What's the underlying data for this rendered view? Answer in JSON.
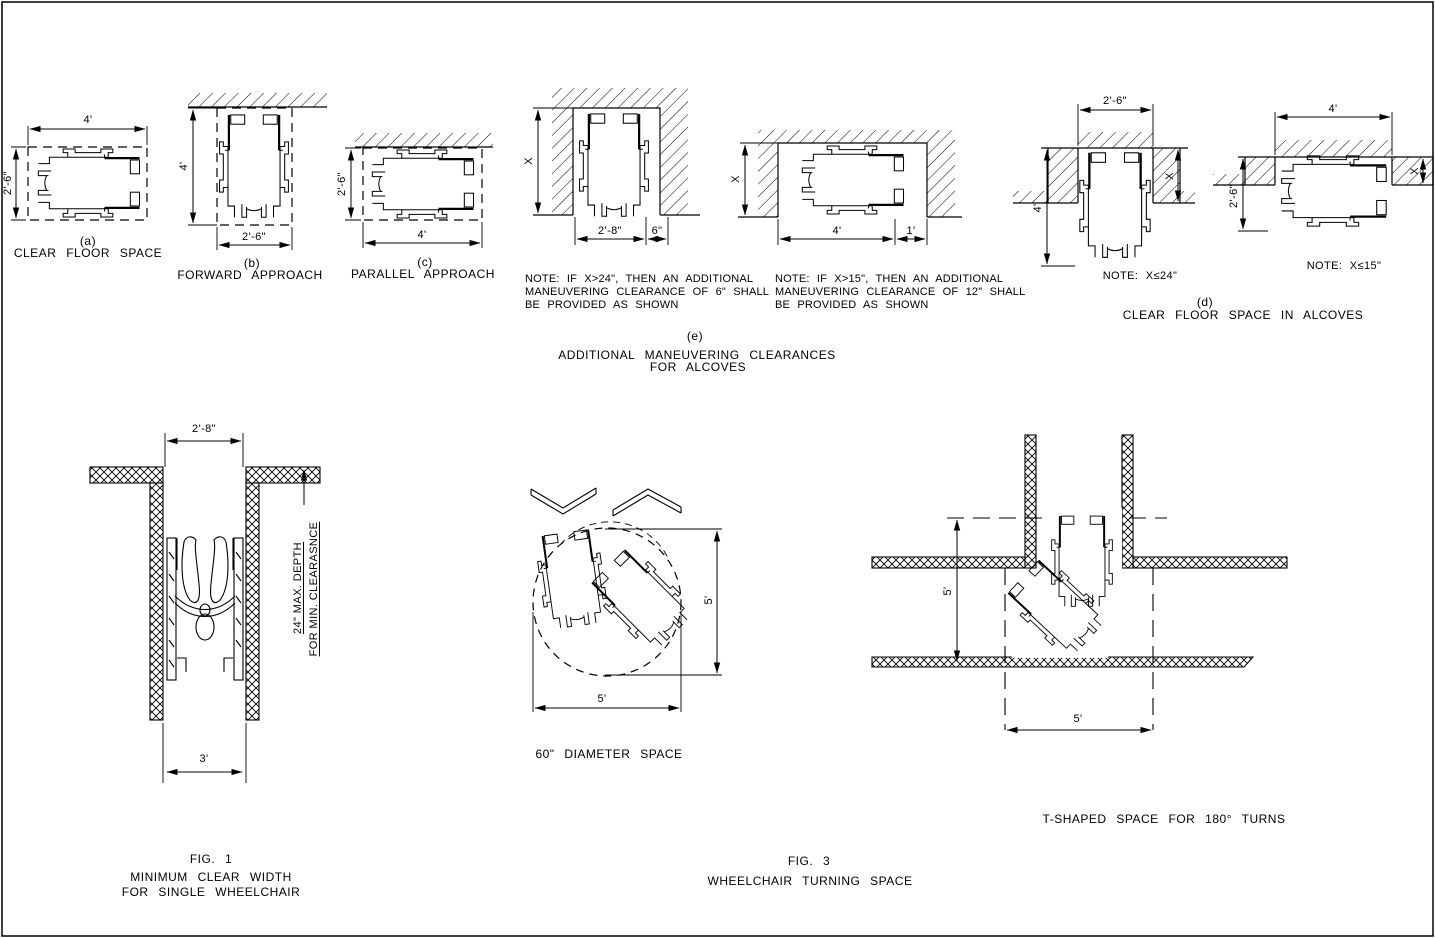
{
  "drawing_title": "Wheelchair clearance and turning space diagrams",
  "colors": {
    "line": "#000000",
    "background": "#ffffff"
  },
  "figures": {
    "a": {
      "tag": "(a)",
      "caption": "CLEAR FLOOR SPACE",
      "dim_width": "4'",
      "dim_height": "2'-6\""
    },
    "b": {
      "tag": "(b)",
      "caption": "FORWARD APPROACH",
      "dim_height": "4'",
      "dim_width": "2'-6\""
    },
    "c": {
      "tag": "(c)",
      "caption": "PARALLEL APPROACH",
      "dim_height": "2'-6\"",
      "dim_width": "4'"
    },
    "e": {
      "tag": "(e)",
      "caption_line1": "ADDITIONAL MANEUVERING CLEARANCES",
      "caption_line2": "FOR ALCOVES",
      "forward_alcove": {
        "dim_x": "X",
        "dim_width": "2'-8\"",
        "dim_extra": "6\"",
        "note_line1": "NOTE: IF X>24\", THEN AN ADDITIONAL",
        "note_line2": "MANEUVERING CLEARANCE OF 6\" SHALL",
        "note_line3": "BE PROVIDED AS SHOWN"
      },
      "parallel_alcove": {
        "dim_x": "X",
        "dim_width": "4'",
        "dim_extra": "1'",
        "note_line1": "NOTE: IF X>15\", THEN AN ADDITIONAL",
        "note_line2": "MANEUVERING CLEARANCE OF 12\" SHALL",
        "note_line3": "BE PROVIDED AS SHOWN"
      }
    },
    "d": {
      "tag": "(d)",
      "caption": "CLEAR FLOOR SPACE IN ALCOVES",
      "forward": {
        "dim_width": "2'-6\"",
        "dim_height": "4'",
        "dim_x": "X",
        "note": "NOTE: X≤24\""
      },
      "parallel": {
        "dim_width": "4'",
        "dim_height": "2'-6\"",
        "dim_x": "X",
        "note": "NOTE: X≤15\""
      }
    },
    "fig1": {
      "tag": "FIG. 1",
      "caption_line1": "MINIMUM CLEAR WIDTH",
      "caption_line2": "FOR SINGLE WHEELCHAIR",
      "dim_top": "2'-8\"",
      "dim_bottom": "3'",
      "depth_note_line1": "24\" MAX. DEPTH",
      "depth_note_line2": "FOR MIN. CLEARASNCE"
    },
    "fig3": {
      "tag": "FIG. 3",
      "caption": "WHEELCHAIR TURNING SPACE",
      "circle": {
        "caption": "60\" DIAMETER SPACE",
        "dim_v": "5'",
        "dim_h": "5'"
      },
      "tshape": {
        "caption": "T-SHAPED SPACE FOR 180° TURNS",
        "dim_v": "5'",
        "dim_h": "5'"
      }
    }
  }
}
